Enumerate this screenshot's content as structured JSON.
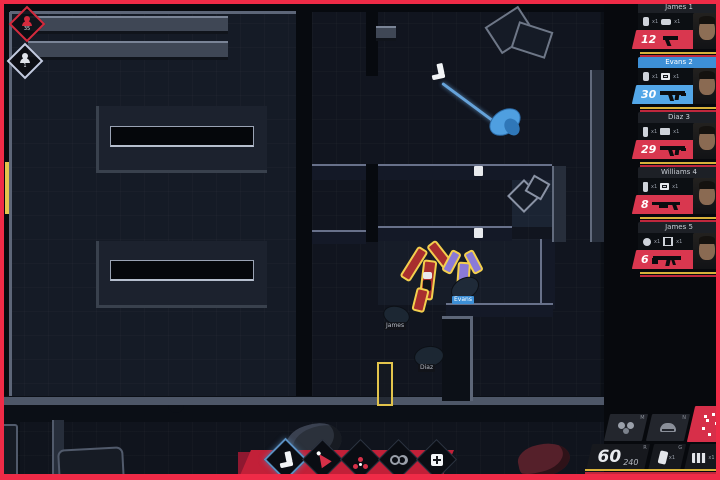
{
  "hud": {
    "counters": {
      "suspects": "35",
      "civilians": "1"
    },
    "squad": [
      {
        "name": "James 1",
        "ammo": "12",
        "weapon": "pistol",
        "selected": false,
        "gear": [
          {
            "icon": "flashbang-icon",
            "qty": "x1"
          },
          {
            "icon": "taser-icon",
            "qty": "x1"
          }
        ]
      },
      {
        "name": "Evans 2",
        "ammo": "30",
        "weapon": "smg",
        "selected": true,
        "gear": [
          {
            "icon": "flashbang-icon",
            "qty": "x1"
          },
          {
            "icon": "breach-charge-icon",
            "qty": "x1"
          }
        ]
      },
      {
        "name": "Diaz 3",
        "ammo": "29",
        "weapon": "smg",
        "selected": false,
        "gear": [
          {
            "icon": "pepper-spray-icon",
            "qty": "x1"
          },
          {
            "icon": "camera-icon",
            "qty": "x1"
          }
        ]
      },
      {
        "name": "Williams 4",
        "ammo": "8",
        "weapon": "shotgun",
        "selected": false,
        "gear": [
          {
            "icon": "pepper-spray-icon",
            "qty": "x1"
          },
          {
            "icon": "breach-charge-icon",
            "qty": "x1"
          }
        ]
      },
      {
        "name": "James 5",
        "ammo": "6",
        "weapon": "rifle",
        "selected": false,
        "gear": [
          {
            "icon": "gas-grenade-icon",
            "qty": "x1"
          },
          {
            "icon": "handcuffs-icon",
            "qty": "x1"
          }
        ]
      }
    ],
    "equipment_panel": {
      "toggles": [
        {
          "icon": "gas-mask-icon",
          "hotkey": "M"
        },
        {
          "icon": "helmet-icon",
          "hotkey": "N"
        },
        {
          "icon": "tactic-scatter-icon",
          "hotkey": ""
        }
      ],
      "ammo": {
        "mag": "60",
        "reserve": "240",
        "hotkey": "R"
      },
      "slots": [
        {
          "icon": "magazine-icon",
          "qty": "x1",
          "hotkey": "G"
        },
        {
          "icon": "breach-charge-icon",
          "qty": "x1",
          "hotkey": "F"
        }
      ]
    },
    "action_bar": [
      {
        "icon": "kick-icon",
        "selected": true
      },
      {
        "icon": "pepper-spray-icon",
        "selected": false
      },
      {
        "icon": "gas-grenade-icon",
        "selected": false
      },
      {
        "icon": "handcuffs-icon",
        "selected": false
      },
      {
        "icon": "medkit-icon",
        "selected": false
      }
    ]
  },
  "map": {
    "unit_labels": {
      "officer_a": "Evans",
      "officer_b": "James",
      "officer_c": "Diaz"
    }
  },
  "colors": {
    "frame_red": "#ef2b47",
    "accent_red": "#d9374f",
    "accent_blue": "#53a7e8",
    "highlight_yellow": "#f3cf4e",
    "panel_dark": "#17191e"
  }
}
